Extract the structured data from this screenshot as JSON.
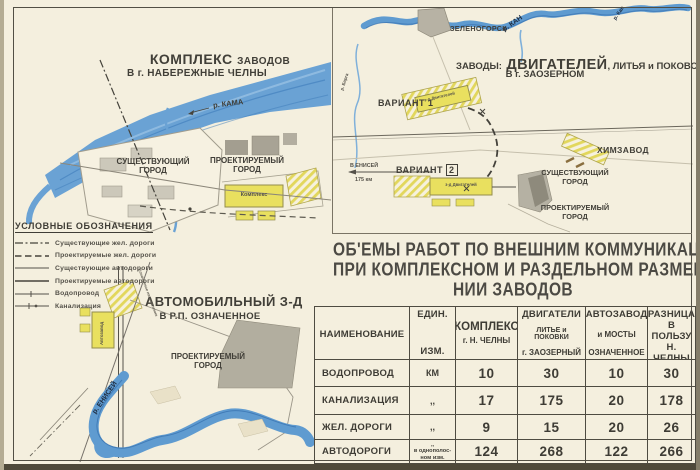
{
  "map_chelny": {
    "title_word1": "КОМПЛЕКС",
    "title_word2": "ЗАВОДОВ",
    "title_line2": "В г. НАБЕРЕЖНЫЕ ЧЕЛНЫ",
    "river_label": "р. КАМА",
    "existing_city_line1": "СУЩЕСТВУЮЩИЙ",
    "existing_city_line2": "ГОРОД",
    "projected_city_line1": "ПРОЕКТИРУЕМЫЙ",
    "projected_city_line2": "ГОРОД",
    "complex_label": "Комплекс"
  },
  "legend": {
    "title": "УСЛОВНЫЕ ОБОЗНАЧЕНИЯ",
    "items": [
      {
        "label": "Существующие жел. дороги"
      },
      {
        "label": "Проектируемые жел. дороги"
      },
      {
        "label": "Существующие автодороги"
      },
      {
        "label": "Проектируемые автодороги"
      },
      {
        "label": "Водопровод"
      },
      {
        "label": "Канализация"
      }
    ]
  },
  "map_oznachennoe": {
    "title_line1": "АВТОМОБИЛЬНЫЙ З-Д",
    "title_line2": "В Р.П. ОЗНАЧЕННОЕ",
    "projected_city_line1": "ПРОЕКТИРУЕМЫЙ",
    "projected_city_line2": "ГОРОД",
    "river_label": "р. ЕНИСЕЙ",
    "plant_label": "Автозавод",
    "road_label": "Означенное направление"
  },
  "map_zaozerny": {
    "title_prefix": "ЗАВОДЫ:",
    "title_main": "ДВИГАТЕЛЕЙ",
    "title_suffix": ", ЛИТЬЯ и ПОКОВОК",
    "title_line2": "В г. ЗАОЗЕРНОМ",
    "zelenogorsk": "ЗЕЛЕНОГОРСК",
    "river_kan": "р. КАН",
    "river_kan_small": "р. Кан",
    "river_barga": "р. Барга",
    "variant1": "ВАРИАНТ 1",
    "variant2": "ВАРИАНТ",
    "variant2_num": "2",
    "enisey_direction": "В ЕНИСЕЙ",
    "enisey_distance": "175 км",
    "plant_box": "з-д Двигателей",
    "himzavod": "ХИМЗАВОД",
    "existing_city_line1": "СУЩЕСТВУЮЩИЙ",
    "existing_city_line2": "ГОРОД",
    "projected_city_line1": "ПРОЕКТИРУЕМЫЙ",
    "projected_city_line2": "ГОРОД"
  },
  "title_block": {
    "line1": "ОБ'ЕМЫ РАБОТ ПО ВНЕШНИМ КОММУНИКАЦИЯМ",
    "line2": "ПРИ КОМПЛЕКСНОМ И РАЗДЕЛЬНОМ РАЗМЕЩЕ-",
    "line3": "НИИ ЗАВОДОВ"
  },
  "table": {
    "col_name": "НАИМЕНОВАНИЕ",
    "col_unit_line1": "ЕДИН.",
    "col_unit_line2": "ИЗМ.",
    "col_complex_line1": "КОМПЛЕКС",
    "col_complex_line2": "г. Н. ЧЕЛНЫ",
    "col_dvig_line1": "ДВИГАТЕЛИ",
    "col_dvig_line2": "ЛИТЬЕ и ПОКОВКИ",
    "col_dvig_line3": "г. ЗАОЗЕРНЫЙ",
    "col_auto_line1": "АВТОЗАВОД",
    "col_auto_line2": "и МОСТЫ",
    "col_auto_line3": "ОЗНАЧЕННОЕ",
    "col_diff_line1": "РАЗНИЦА",
    "col_diff_line2": "В ПОЛЬЗУ",
    "col_diff_line3": "Н. ЧЕЛНЫ",
    "rows": [
      {
        "name": "ВОДОПРОВОД",
        "unit": "КМ",
        "complex": "10",
        "dvig": "30",
        "auto": "10",
        "diff": "30"
      },
      {
        "name": "КАНАЛИЗАЦИЯ",
        "unit": ",,",
        "complex": "17",
        "dvig": "175",
        "auto": "20",
        "diff": "178"
      },
      {
        "name": "ЖЕЛ. ДОРОГИ",
        "unit": ",,",
        "complex": "9",
        "dvig": "15",
        "auto": "20",
        "diff": "26"
      },
      {
        "name": "АВТОДОРОГИ",
        "unit_line1": ",,",
        "unit_line2": "в однополос-",
        "unit_line3": "ном изм.",
        "complex": "124",
        "dvig": "268",
        "auto": "122",
        "diff": "266"
      }
    ]
  }
}
